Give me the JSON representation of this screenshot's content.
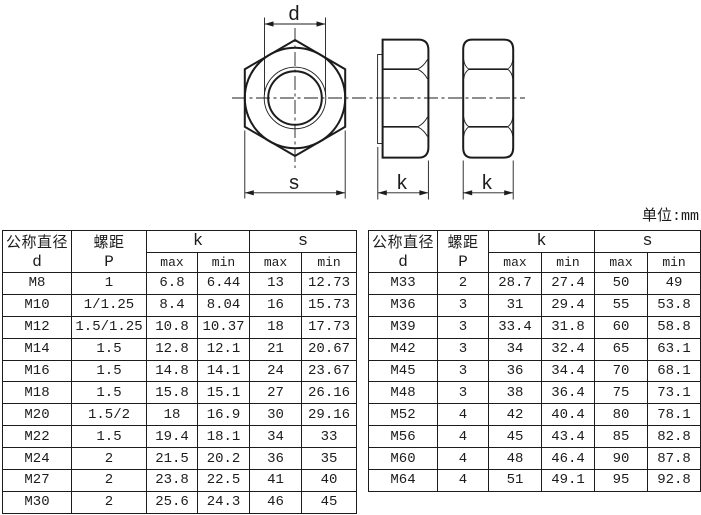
{
  "colors": {
    "background": "#ffffff",
    "ink": "#1c1c1c"
  },
  "unit_note": "单位:mm",
  "diagram": {
    "description": "hex-nut-three-view-technical-drawing",
    "dim_labels": {
      "d": "d",
      "s": "s",
      "k_left": "k",
      "k_right": "k"
    }
  },
  "tables": {
    "header": {
      "diameter_label": "公称直径",
      "diameter_symbol": "d",
      "pitch_label": "螺距",
      "pitch_symbol": "P",
      "k_label": "k",
      "s_label": "s",
      "max_label": "max",
      "min_label": "min"
    },
    "left": {
      "rows": [
        [
          "M8",
          "1",
          "6.8",
          "6.44",
          "13",
          "12.73"
        ],
        [
          "M10",
          "1/1.25",
          "8.4",
          "8.04",
          "16",
          "15.73"
        ],
        [
          "M12",
          "1.5/1.25",
          "10.8",
          "10.37",
          "18",
          "17.73"
        ],
        [
          "M14",
          "1.5",
          "12.8",
          "12.1",
          "21",
          "20.67"
        ],
        [
          "M16",
          "1.5",
          "14.8",
          "14.1",
          "24",
          "23.67"
        ],
        [
          "M18",
          "1.5",
          "15.8",
          "15.1",
          "27",
          "26.16"
        ],
        [
          "M20",
          "1.5/2",
          "18",
          "16.9",
          "30",
          "29.16"
        ],
        [
          "M22",
          "1.5",
          "19.4",
          "18.1",
          "34",
          "33"
        ],
        [
          "M24",
          "2",
          "21.5",
          "20.2",
          "36",
          "35"
        ],
        [
          "M27",
          "2",
          "23.8",
          "22.5",
          "41",
          "40"
        ],
        [
          "M30",
          "2",
          "25.6",
          "24.3",
          "46",
          "45"
        ]
      ]
    },
    "right": {
      "rows": [
        [
          "M33",
          "2",
          "28.7",
          "27.4",
          "50",
          "49"
        ],
        [
          "M36",
          "3",
          "31",
          "29.4",
          "55",
          "53.8"
        ],
        [
          "M39",
          "3",
          "33.4",
          "31.8",
          "60",
          "58.8"
        ],
        [
          "M42",
          "3",
          "34",
          "32.4",
          "65",
          "63.1"
        ],
        [
          "M45",
          "3",
          "36",
          "34.4",
          "70",
          "68.1"
        ],
        [
          "M48",
          "3",
          "38",
          "36.4",
          "75",
          "73.1"
        ],
        [
          "M52",
          "4",
          "42",
          "40.4",
          "80",
          "78.1"
        ],
        [
          "M56",
          "4",
          "45",
          "43.4",
          "85",
          "82.8"
        ],
        [
          "M60",
          "4",
          "48",
          "46.4",
          "90",
          "87.8"
        ],
        [
          "M64",
          "4",
          "51",
          "49.1",
          "95",
          "92.8"
        ]
      ]
    }
  }
}
